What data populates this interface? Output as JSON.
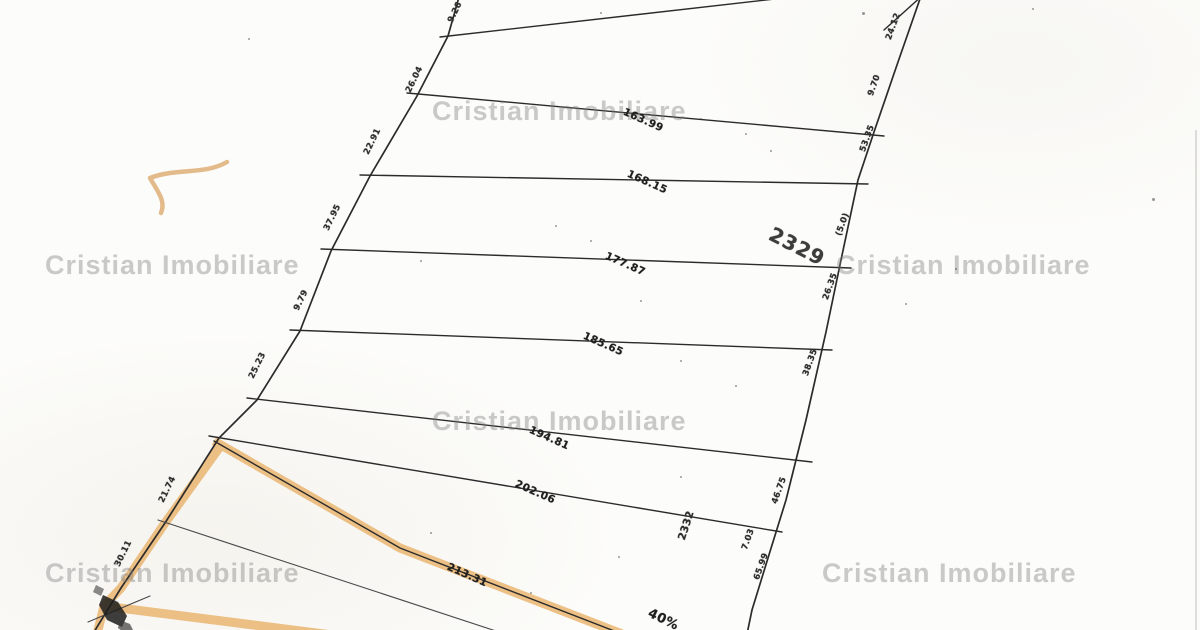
{
  "watermark": {
    "text": "Cristian Imobiliare",
    "color": "rgba(124,124,124,0.40)",
    "positions": [
      {
        "x": 432,
        "y": 96
      },
      {
        "x": 45,
        "y": 250
      },
      {
        "x": 836,
        "y": 250
      },
      {
        "x": 432,
        "y": 406
      },
      {
        "x": 45,
        "y": 558
      },
      {
        "x": 822,
        "y": 558
      }
    ]
  },
  "plan": {
    "description": "scanned cadastral parcel plan",
    "paper_color": "#fcfcfa",
    "ink_color": "#2b2b2b",
    "highlight_color": "#eab671",
    "line_lengths_m": [
      "163.99",
      "168.15",
      "177.87",
      "185.65",
      "194.81",
      "202.06",
      "213.31"
    ],
    "parcel_numbers": [
      "2329",
      "2332"
    ],
    "left_edge_widths_m": [
      "9.26",
      "26.04",
      "22.91",
      "37.95",
      "9.79",
      "25.23",
      "21.74",
      "30.11"
    ],
    "right_edge_widths_m": [
      "24.12",
      "9.70",
      "53.35",
      "(5.0)",
      "26.35",
      "38.35",
      "46.75",
      "7.03",
      "65.99"
    ],
    "corner_note": "40%"
  },
  "labels": [
    {
      "text": "163.99",
      "x": 626,
      "y": 106,
      "rot": 24,
      "cls": "m",
      "name": "line-length-label"
    },
    {
      "text": "168.15",
      "x": 630,
      "y": 168,
      "rot": 24,
      "cls": "m",
      "name": "line-length-label"
    },
    {
      "text": "177.87",
      "x": 608,
      "y": 250,
      "rot": 24,
      "cls": "m",
      "name": "line-length-label"
    },
    {
      "text": "185.65",
      "x": 586,
      "y": 330,
      "rot": 24,
      "cls": "m",
      "name": "line-length-label"
    },
    {
      "text": "194.81",
      "x": 532,
      "y": 424,
      "rot": 24,
      "cls": "m",
      "name": "line-length-label"
    },
    {
      "text": "202.06",
      "x": 518,
      "y": 478,
      "rot": 24,
      "cls": "m",
      "name": "line-length-label"
    },
    {
      "text": "213.31",
      "x": 450,
      "y": 561,
      "rot": 24,
      "cls": "m",
      "name": "line-length-label"
    },
    {
      "text": "9.26",
      "x": 446,
      "y": 20,
      "rot": -64,
      "cls": "s",
      "name": "edge-width-label"
    },
    {
      "text": "26.04",
      "x": 404,
      "y": 90,
      "rot": -64,
      "cls": "s",
      "name": "edge-width-label"
    },
    {
      "text": "22.91",
      "x": 362,
      "y": 152,
      "rot": -64,
      "cls": "s",
      "name": "edge-width-label"
    },
    {
      "text": "37.95",
      "x": 322,
      "y": 228,
      "rot": -64,
      "cls": "s",
      "name": "edge-width-label"
    },
    {
      "text": "9.79",
      "x": 292,
      "y": 308,
      "rot": -64,
      "cls": "s",
      "name": "edge-width-label"
    },
    {
      "text": "25.23",
      "x": 247,
      "y": 376,
      "rot": -64,
      "cls": "s",
      "name": "edge-width-label"
    },
    {
      "text": "21.74",
      "x": 157,
      "y": 500,
      "rot": -64,
      "cls": "s",
      "name": "edge-width-label"
    },
    {
      "text": "30.11",
      "x": 113,
      "y": 564,
      "rot": -64,
      "cls": "s",
      "name": "edge-width-label"
    },
    {
      "text": "24.12",
      "x": 884,
      "y": 38,
      "rot": -70,
      "cls": "s",
      "name": "edge-width-label"
    },
    {
      "text": "9.70",
      "x": 866,
      "y": 94,
      "rot": -70,
      "cls": "s",
      "name": "edge-width-label"
    },
    {
      "text": "53.35",
      "x": 858,
      "y": 150,
      "rot": -70,
      "cls": "s",
      "name": "edge-width-label"
    },
    {
      "text": "(5.0)",
      "x": 834,
      "y": 234,
      "rot": -70,
      "cls": "s",
      "name": "edge-width-label"
    },
    {
      "text": "26.35",
      "x": 821,
      "y": 298,
      "rot": -70,
      "cls": "s",
      "name": "edge-width-label"
    },
    {
      "text": "38.35",
      "x": 801,
      "y": 374,
      "rot": -70,
      "cls": "s",
      "name": "edge-width-label"
    },
    {
      "text": "46.75",
      "x": 770,
      "y": 502,
      "rot": -70,
      "cls": "s",
      "name": "edge-width-label"
    },
    {
      "text": "7.03",
      "x": 740,
      "y": 548,
      "rot": -70,
      "cls": "s",
      "name": "edge-width-label"
    },
    {
      "text": "65.99",
      "x": 752,
      "y": 578,
      "rot": -70,
      "cls": "s",
      "name": "edge-width-label"
    },
    {
      "text": "2329",
      "x": 776,
      "y": 222,
      "rot": 27,
      "cls": "big",
      "size": 20,
      "name": "parcel-number-label"
    },
    {
      "text": "2332",
      "x": 676,
      "y": 538,
      "rot": -72,
      "cls": "s",
      "size": 10.5,
      "name": "parcel-number-label"
    },
    {
      "text": "40%",
      "x": 652,
      "y": 606,
      "rot": 26,
      "cls": "m",
      "size": 13,
      "name": "corner-note-label"
    }
  ]
}
